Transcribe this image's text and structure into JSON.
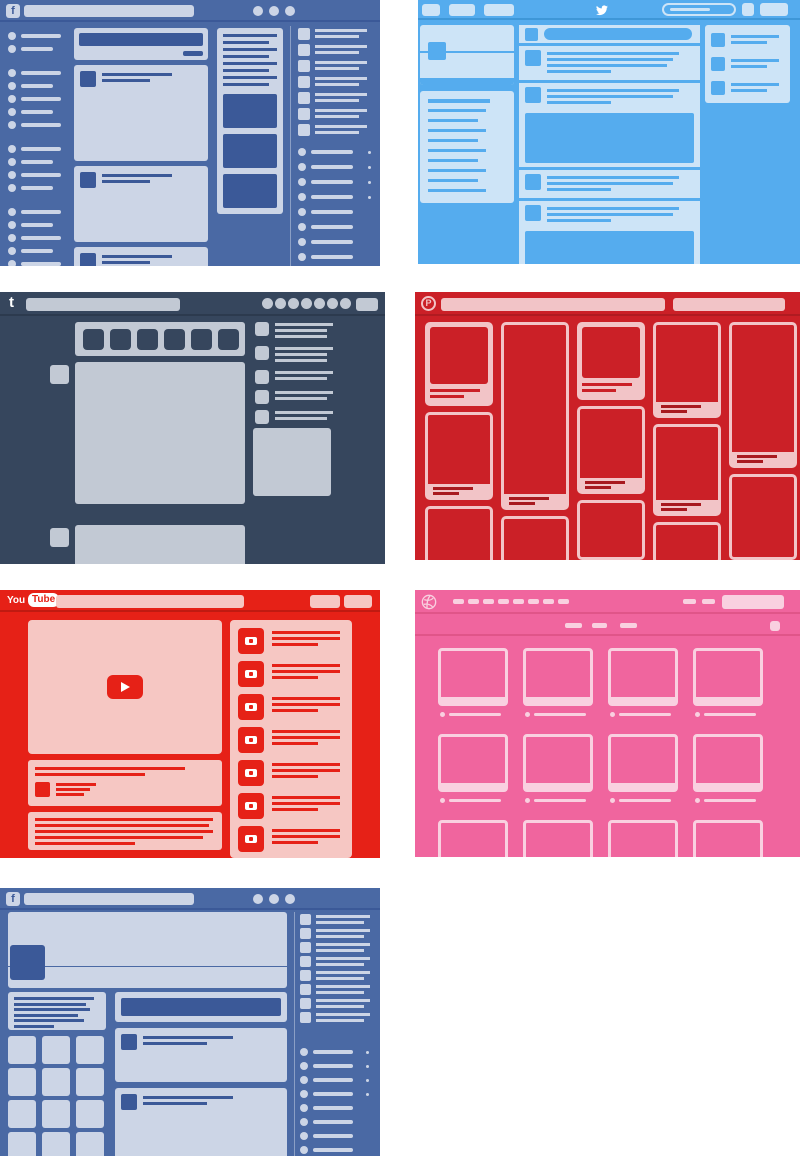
{
  "page": {
    "background": "#ffffff"
  },
  "panels": {
    "facebook_feed": {
      "site": "Facebook",
      "view": "news-feed-wireframe",
      "logo_text": "f",
      "colors": {
        "bg": "#4a69a4",
        "light": "#ccd5e6",
        "dark": "#3b5998",
        "hline": "#3b5998"
      },
      "window_dots": 3,
      "nav_groups": [
        2,
        5,
        4,
        6
      ],
      "posts": [
        96,
        76,
        40
      ],
      "ad": {
        "lines": 8,
        "images": 3
      },
      "contacts": 7,
      "chat": {
        "items": 8,
        "status_dots": 4
      }
    },
    "twitter": {
      "site": "Twitter",
      "view": "home-timeline-wireframe",
      "logo_icon": "twitter-bird",
      "colors": {
        "bg": "#55acee",
        "light": "#cde4f7",
        "accent": "#55acee",
        "hline": "#3e97d8"
      },
      "nav_tabs": [
        18,
        26,
        30
      ],
      "trends_lines": 10,
      "timeline": [
        {
          "type": "compose"
        },
        {
          "type": "tweet",
          "lines": 4
        },
        {
          "type": "tweet",
          "lines": 3
        },
        {
          "type": "image"
        },
        {
          "type": "tweet",
          "lines": 3
        },
        {
          "type": "tweet",
          "lines": 3
        },
        {
          "type": "image"
        }
      ],
      "who_to_follow": 3
    },
    "tumblr": {
      "site": "Tumblr",
      "view": "dashboard-wireframe",
      "logo_text": "t",
      "colors": {
        "bg": "#36465d",
        "light": "#c2c9d4",
        "hline": "#2c3a4e"
      },
      "header_circles": 7,
      "post_type_buttons": 6,
      "posts": [
        {
          "top": 70,
          "h": 142
        },
        {
          "top": 233,
          "h": 60
        }
      ],
      "sidebar_items": [
        3,
        3,
        2,
        2,
        2
      ],
      "radar_block": true
    },
    "pinterest": {
      "site": "Pinterest",
      "view": "masonry-board-wireframe",
      "logo_text": "P",
      "colors": {
        "bg": "#cb2027",
        "light": "#f2c4c7",
        "linedark": "#a8191f",
        "hline": "#b01b21"
      },
      "columns": [
        [
          {
            "v": "photo",
            "h": 84
          },
          {
            "v": "outline",
            "h": 88
          },
          {
            "v": "plain",
            "h": 60
          }
        ],
        [
          {
            "v": "outline",
            "h": 188
          },
          {
            "v": "plain",
            "h": 48
          }
        ],
        [
          {
            "v": "photo",
            "h": 78
          },
          {
            "v": "outline",
            "h": 88
          },
          {
            "v": "plain",
            "h": 60
          }
        ],
        [
          {
            "v": "outline",
            "h": 96
          },
          {
            "v": "outline",
            "h": 92
          },
          {
            "v": "plain",
            "h": 42
          }
        ],
        [
          {
            "v": "outline",
            "h": 146
          },
          {
            "v": "plain",
            "h": 86
          }
        ]
      ]
    },
    "youtube": {
      "site": "YouTube",
      "view": "watch-page-wireframe",
      "logo_text_you": "You",
      "logo_text_tube": "Tube",
      "colors": {
        "bg": "#e62117",
        "light": "#f6c7c3",
        "accent": "#e62117",
        "hline": "#c01a11"
      },
      "title_lines": 2,
      "channel_lines": 3,
      "description_lines": 5,
      "related_videos": 7
    },
    "dribbble": {
      "site": "Dribbble",
      "view": "shots-grid-wireframe",
      "logo_icon": "dribbble-ball",
      "colors": {
        "bg": "#f0659e",
        "light": "#f9d0e0",
        "hline": "#e05589"
      },
      "nav_dashes": 8,
      "right_dashes": 2,
      "sub_dashes": 3,
      "grid": {
        "cols": 4,
        "rows": 3
      }
    },
    "facebook_profile": {
      "site": "Facebook",
      "view": "profile-wireframe",
      "logo_text": "f",
      "colors": {
        "bg": "#4a69a4",
        "light": "#ccd5e6",
        "dark": "#3b5998",
        "hline": "#3b5998"
      },
      "window_dots": 3,
      "about_lines": 6,
      "photo_grid": {
        "cols": 3,
        "rows": 4
      },
      "posts": [
        {
          "top": 140,
          "h": 54
        },
        {
          "top": 200,
          "h": 80
        }
      ],
      "sidebar_items": 8,
      "chat": {
        "items": 8,
        "status_dots": 4
      }
    }
  }
}
